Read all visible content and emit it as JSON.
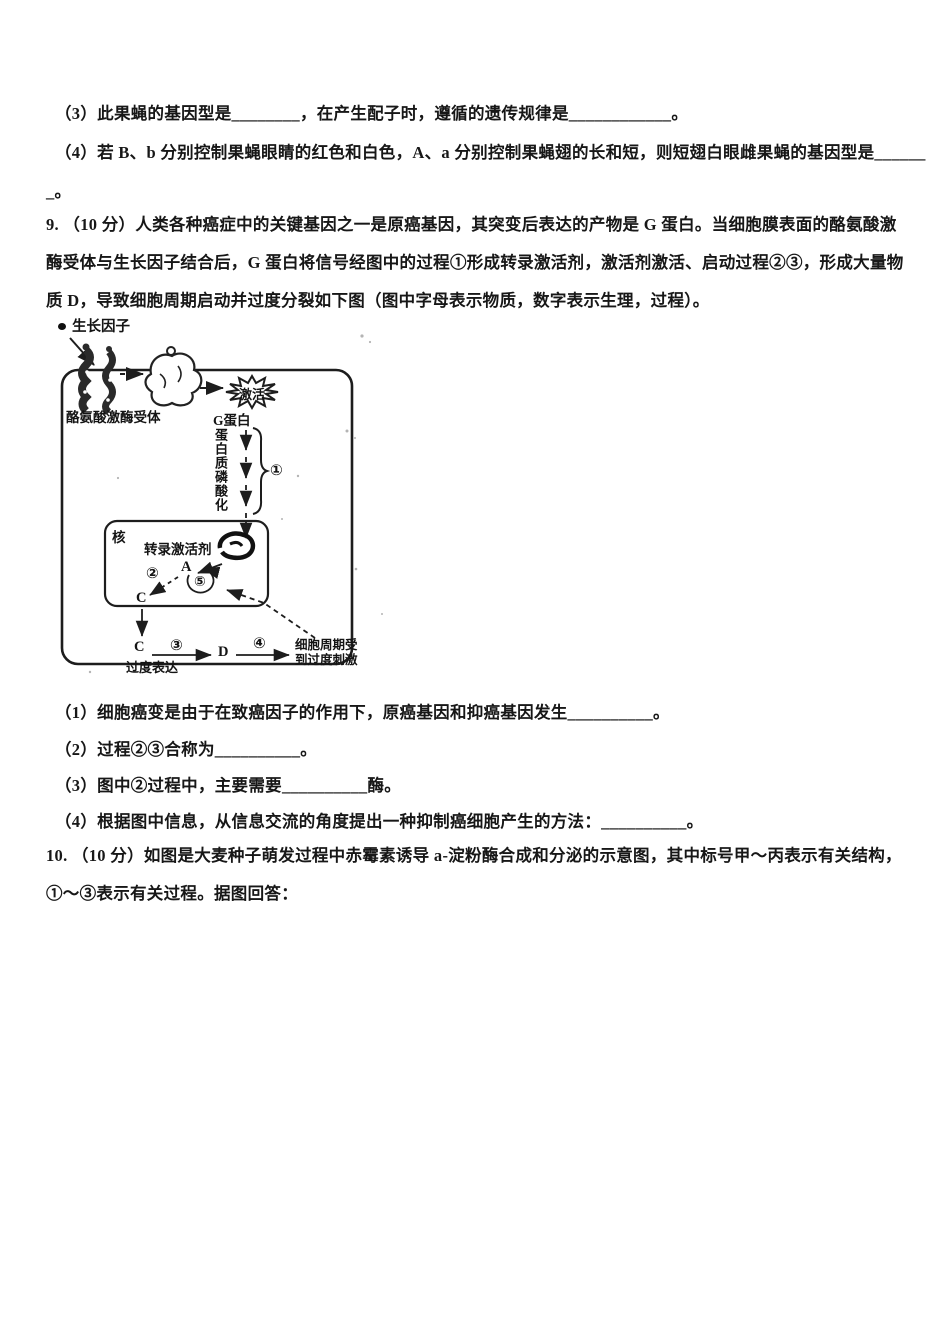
{
  "colors": {
    "ink": "#171717",
    "paper": "#ffffff"
  },
  "q8": {
    "line3": "（3）此果蝇的基因型是________，在产生配子时，遵循的遗传规律是____________。",
    "line4": "（4）若 B、b 分别控制果蝇眼睛的红色和白色，A、a 分别控制果蝇翅的长和短，则短翅白眼雌果蝇的基因型是______",
    "line4cont": "_。"
  },
  "q9": {
    "stem1": "9. （10 分）人类各种癌症中的关键基因之一是原癌基因，其突变后表达的产物是 G 蛋白。当细胞膜表面的酪氨酸激",
    "stem2": "酶受体与生长因子结合后，G 蛋白将信号经图中的过程①形成转录激活剂，激活剂激活、启动过程②③，形成大量物",
    "stem3": "质 D，导致细胞周期启动并过度分裂如下图（图中字母表示物质，数字表示生理，过程）。",
    "sub1": "（1）细胞癌变是由于在致癌因子的作用下，原癌基因和抑癌基因发生__________。",
    "sub2": "（2）过程②③合称为__________。",
    "sub3": "（3）图中②过程中，主要需要__________酶。",
    "sub4": "（4）根据图中信息，从信息交流的角度提出一种抑制癌细胞产生的方法：__________。"
  },
  "figure": {
    "growth_factor": "生长因子",
    "receptor": "酪氨酸激酶受体",
    "activated": "激活",
    "g_protein": "G蛋白",
    "phospho": "蛋白质磷酸化",
    "step1": "①",
    "nucleus": "核",
    "activator": "转录激活剂",
    "label_a": "A",
    "step2": "②",
    "step5": "⑤",
    "label_c1": "C",
    "label_c2": "C",
    "overexpression": "过度表达",
    "step3": "③",
    "label_d": "D",
    "step4": "④",
    "result1": "细胞周期受",
    "result2": "到过度刺激"
  },
  "q10": {
    "stem1": "10. （10 分）如图是大麦种子萌发过程中赤霉素诱导 a-淀粉酶合成和分泌的示意图，其中标号甲～丙表示有关结构，",
    "stem2": "①～③表示有关过程。据图回答："
  }
}
